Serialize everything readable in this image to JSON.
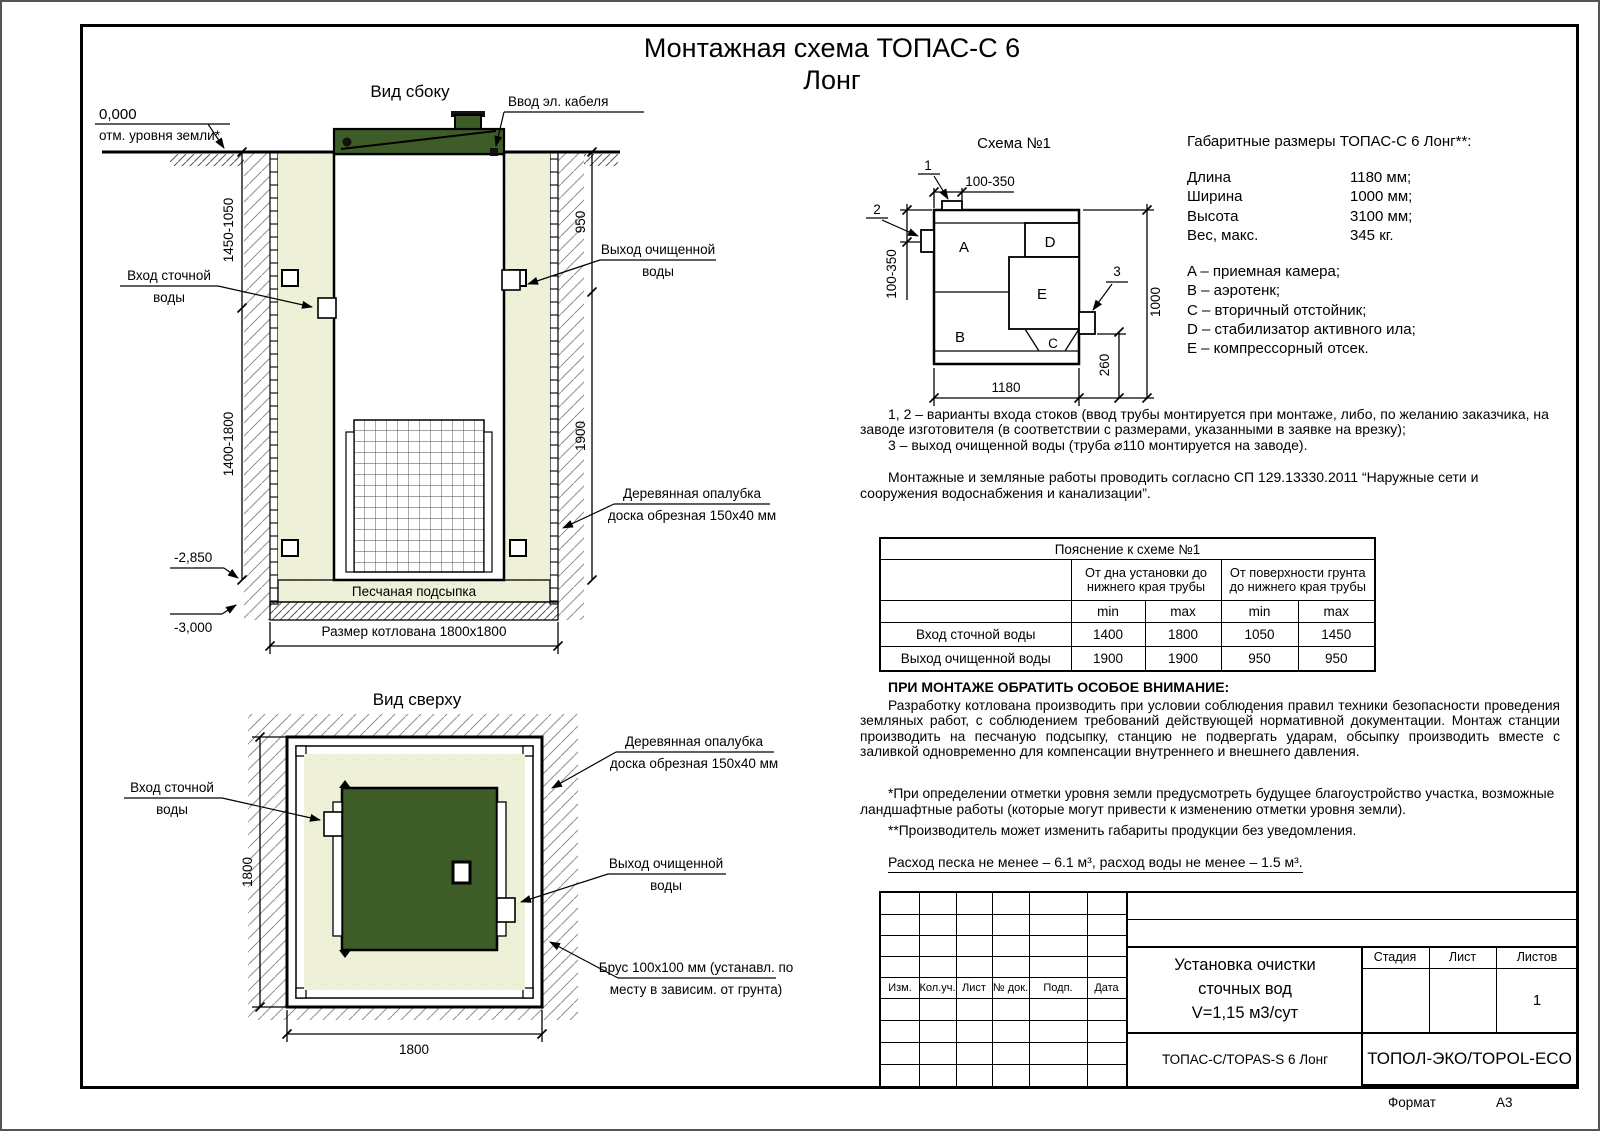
{
  "page": {
    "title_line1": "Монтажная схема ТОПАС-С 6",
    "title_line2": "Лонг",
    "format_label": "Формат",
    "format_value": "А3"
  },
  "side_view": {
    "title": "Вид сбоку",
    "zero_mark": "0,000",
    "zero_note": "отм. уровня земли*",
    "cable_label": "Ввод эл. кабеля",
    "inlet_line1": "Вход сточной",
    "inlet_line2": "воды",
    "outlet_line1": "Выход очищенной",
    "outlet_line2": "воды",
    "formwork_line1": "Деревянная опалубка",
    "formwork_line2": "доска обрезная 150х40 мм",
    "bedding_label": "Песчаная подсыпка",
    "pit_dim_label": "Размер котлована 1800х1800",
    "level_2850": "-2,850",
    "level_3000": "-3,000",
    "dim_left_top": "1450-1050",
    "dim_left_bottom": "1400-1800",
    "dim_right_top": "950",
    "dim_right_bottom": "1900"
  },
  "top_view": {
    "title": "Вид сверху",
    "inlet_line1": "Вход сточной",
    "inlet_line2": "воды",
    "outlet_line1": "Выход очищенной",
    "outlet_line2": "воды",
    "formwork_line1": "Деревянная опалубка",
    "formwork_line2": "доска обрезная 150х40 мм",
    "beam_line1": "Брус 100х100 мм (устанавл. по",
    "beam_line2": "месту в зависим. от грунта)",
    "dim_width": "1800",
    "dim_height": "1800"
  },
  "schema": {
    "title": "Схема №1",
    "letter_a": "A",
    "letter_b": "B",
    "letter_c": "C",
    "letter_d": "D",
    "letter_e": "E",
    "callout_1": "1",
    "callout_2": "2",
    "callout_3": "3",
    "dim_top": "100-350",
    "dim_left": "100-350",
    "dim_bottom": "1180",
    "dim_right": "1000",
    "dim_outlet": "260"
  },
  "specs": {
    "title": "Габаритные размеры ТОПАС-С 6 Лонг**:",
    "rows": [
      {
        "name": "Длина",
        "value": "1180 мм;"
      },
      {
        "name": "Ширина",
        "value": "1000 мм;"
      },
      {
        "name": "Высота",
        "value": "3100 мм;"
      },
      {
        "name": "Вес, макс.",
        "value": "345 кг."
      }
    ],
    "legend": [
      "A – приемная камера;",
      "B – аэротенк;",
      "C – вторичный отстойник;",
      "D – стабилизатор активного ила;",
      "E – компрессорный отсек."
    ]
  },
  "notes": {
    "p1": "1, 2 – варианты входа  стоков (ввод трубы монтируется при монтаже, либо, по желанию заказчика, на заводе изготовителя (в соответствии с размерами, указанными в заявке на врезку);",
    "p2": "3 – выход очищенной воды (труба ⌀110 монтируется на заводе).",
    "p3": "Монтажные и земляные работы проводить согласно СП 129.13330.2011 “Наружные сети и сооружения водоснабжения и канализации”."
  },
  "table": {
    "title": "Пояснение к схеме №1",
    "group1": "От дна установки до нижнего края трубы",
    "group2": "От поверхности грунта до нижнего края трубы",
    "min": "min",
    "max": "max",
    "rows": [
      {
        "name": "Вход сточной воды",
        "v1": "1400",
        "v2": "1800",
        "v3": "1050",
        "v4": "1450"
      },
      {
        "name": "Выход очищенной воды",
        "v1": "1900",
        "v2": "1900",
        "v3": "950",
        "v4": "950"
      }
    ]
  },
  "attention": {
    "heading": "ПРИ МОНТАЖЕ ОБРАТИТЬ ОСОБОЕ ВНИМАНИЕ:",
    "body": "Разработку котлована производить при условии соблюдения правил техники безопасности проведения земляных работ, с соблюдением требований действующей нормативной документации. Монтаж станции производить на песчаную подсыпку, станцию не подвергать ударам, обсыпку производить вместе с заливкой одновременно для компенсации внутреннего и внешнего давления.",
    "footnote1": "*При определении отметки уровня земли предусмотреть будущее благоустройство участка, возможные ландшафтные работы (которые могут привести к изменению отметки уровня земли).",
    "footnote2": "**Производитель может изменить габариты продукции без уведомления.",
    "consumption": "Расход песка не менее – 6.1 м³, расход воды не менее – 1.5 м³."
  },
  "title_block": {
    "rev_headers": [
      "Изм.",
      "Кол.уч.",
      "Лист",
      "№ док.",
      "Подп.",
      "Дата"
    ],
    "doc_title_1": "Установка очистки",
    "doc_title_2": "сточных вод",
    "doc_title_3": "V=1,15 м3/сут",
    "stage_label": "Стадия",
    "sheet_label": "Лист",
    "sheets_label": "Листов",
    "sheets_value": "1",
    "product": "ТОПАС-С/TOPAS-S 6 Лонг",
    "company": "ТОПОЛ-ЭКО/TOPOL-ECO"
  },
  "colors": {
    "station_green": "#3e5c27",
    "sand": "#eef0d8"
  }
}
